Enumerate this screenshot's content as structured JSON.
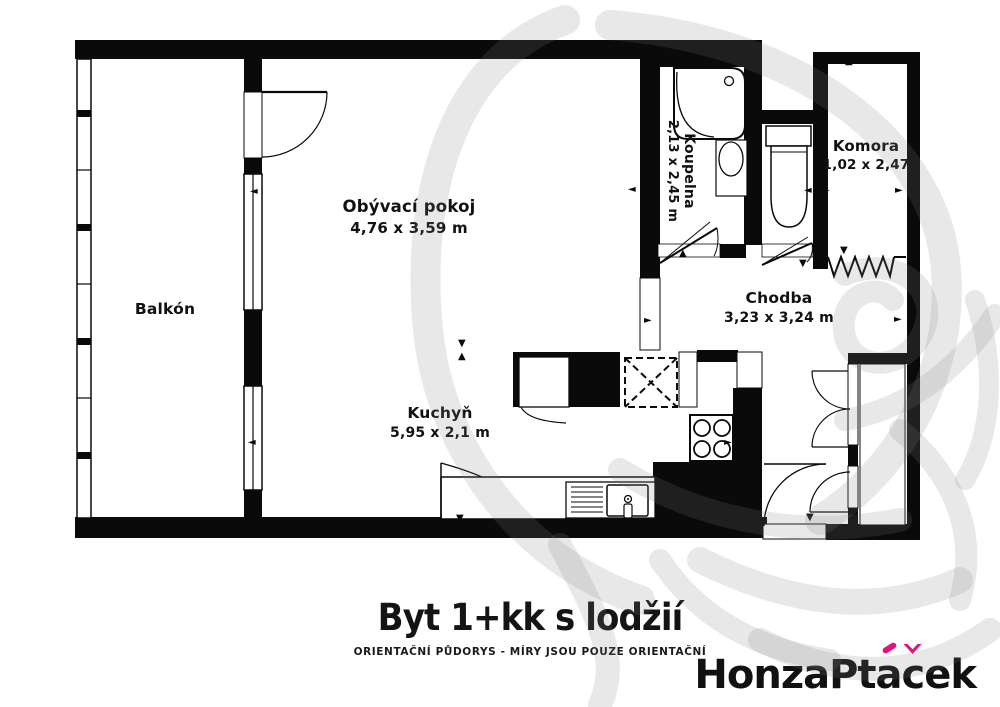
{
  "colors": {
    "wall": "#0a0a0a",
    "background": "#ffffff",
    "accent_pink": "#e3137a",
    "watermark_gray": "#7d7d7d"
  },
  "plan": {
    "rooms": [
      {
        "name": "Balkón",
        "dims": ""
      },
      {
        "name": "Obývací pokoj",
        "dims": "4,76 x 3,59 m"
      },
      {
        "name": "Koupelna",
        "dims": "2,13 x 2,45 m"
      },
      {
        "name": "Komora",
        "dims": "1,02 x 2,47"
      },
      {
        "name": "Chodba",
        "dims": "3,23 x 3,24 m"
      },
      {
        "name": "Kuchyň",
        "dims": "5,95 x 2,1 m"
      }
    ]
  },
  "icons": {
    "up": "▲",
    "down": "▼",
    "left": "◄",
    "right": "►"
  },
  "footer": {
    "title": "Byt 1+kk s lodžií",
    "subtitle": "ORIENTAČNÍ PŮDORYS - MÍRY JSOU POUZE ORIENTAČNÍ"
  },
  "logo": {
    "part1": "HonzaPt",
    "a_base": "a",
    "c_base": "c",
    "part2": "ek",
    "full_name": "HonzaPtáček"
  }
}
